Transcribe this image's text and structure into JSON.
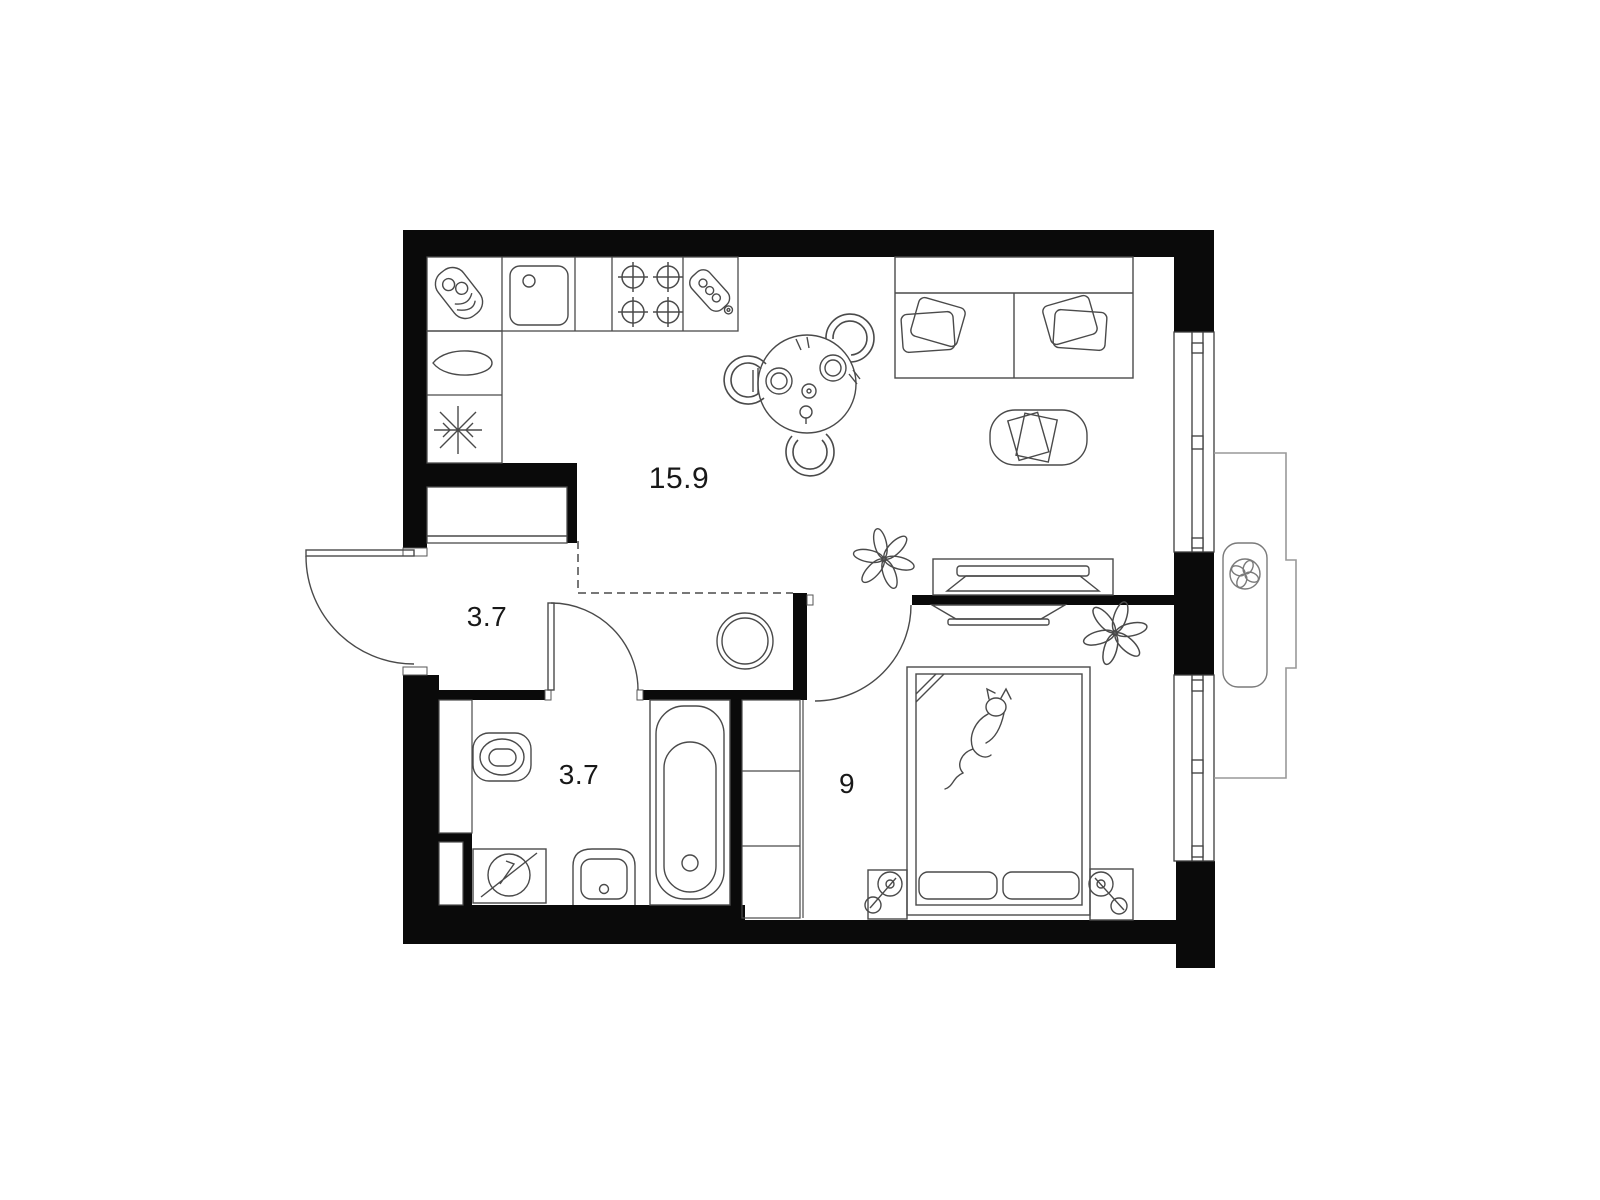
{
  "plan": {
    "type": "apartment-floor-plan",
    "background": "#ffffff",
    "colors": {
      "wall": "#0a0a0a",
      "furniture_line": "#4a4a4a",
      "balcony_line": "#999999",
      "dashed_zone_line": "#777777",
      "label_text": "#181818"
    },
    "rooms": [
      {
        "id": "kitchen-living-room",
        "area_label": "15.9"
      },
      {
        "id": "hallway",
        "area_label": "3.7"
      },
      {
        "id": "bathroom",
        "area_label": "3.7"
      },
      {
        "id": "bedroom",
        "area_label": "9"
      }
    ],
    "icons": [
      "dish-rack-icon",
      "kitchen-sink-icon",
      "stove-burners-icon",
      "cutting-board-icon",
      "kettle-icon",
      "fridge-snowflake-icon",
      "wardrobe-icon",
      "entrance-door-arc",
      "dining-table-icon",
      "chair-icon",
      "sofa-icon",
      "pillow-icon",
      "coffee-table-icon",
      "magazines-icon",
      "tv-console-icon",
      "tv-icon",
      "plant-icon",
      "water-heater-icon",
      "toilet-icon",
      "washing-machine-icon",
      "bath-sink-icon",
      "bathtub-icon",
      "bathroom-door-arc",
      "bedroom-door-arc",
      "closet-shelves-icon",
      "bed-icon",
      "cat-icon",
      "nightstand-lamp-icon",
      "window-glazing",
      "balcony-outline",
      "ac-fan-icon"
    ]
  }
}
